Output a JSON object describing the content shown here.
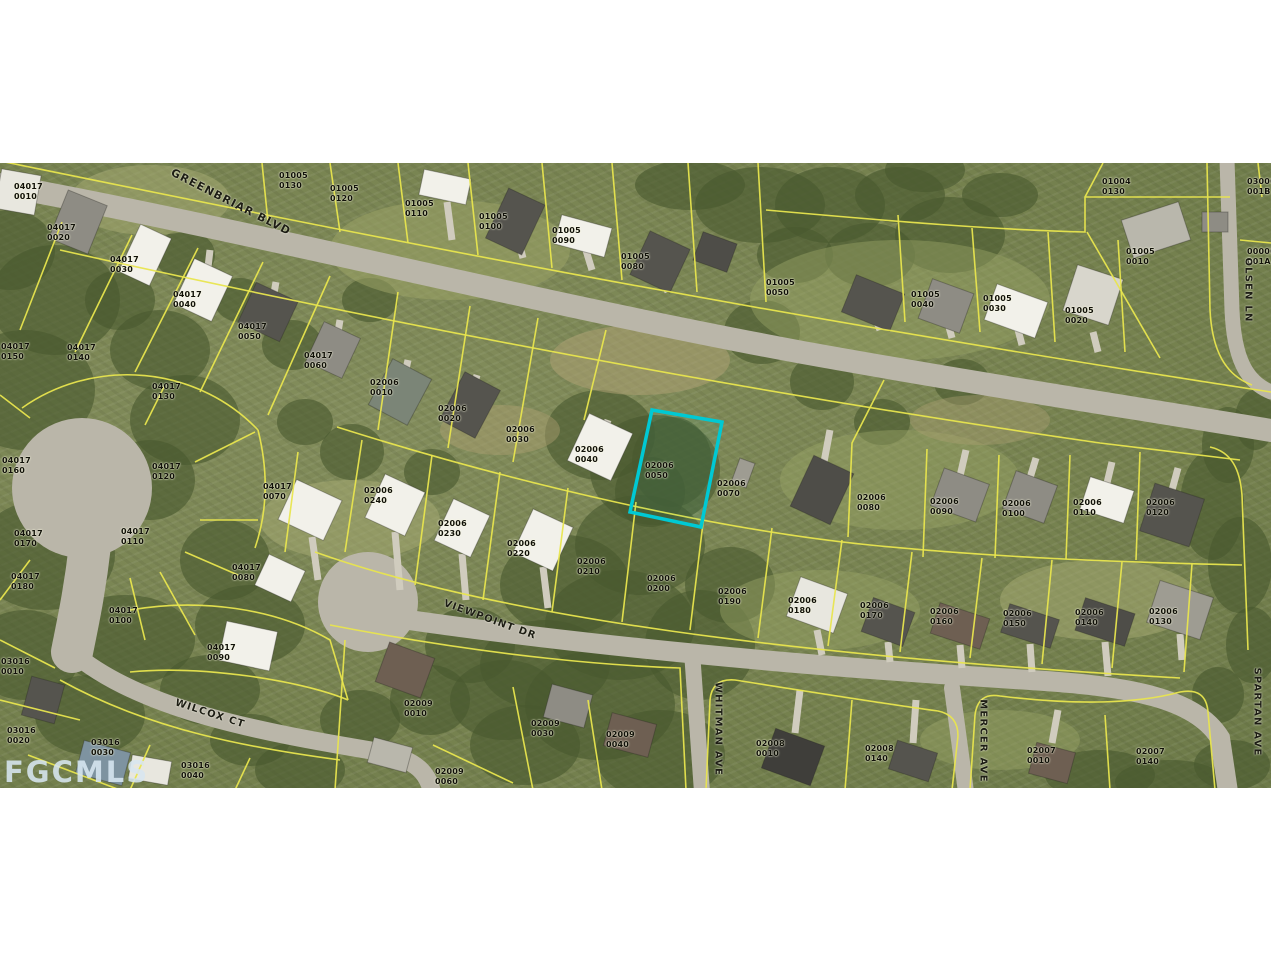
{
  "map": {
    "watermark": "FGCMLS",
    "highlighted_parcel_id": "02006 0050",
    "highlight_color": "#00c9d4",
    "parcel_line_color": "#e8e54e",
    "street_labels": [
      {
        "name": "GREENBRIAR BLVD",
        "x": 231,
        "y": 202,
        "rot": 27,
        "size": 11
      },
      {
        "name": "VIEWPOINT DR",
        "x": 490,
        "y": 620,
        "rot": 20,
        "size": 10
      },
      {
        "name": "WILCOX CT",
        "x": 210,
        "y": 714,
        "rot": 18,
        "size": 10
      },
      {
        "name": "WHITMAN AVE",
        "x": 718,
        "y": 729,
        "rot": 90,
        "size": 10
      },
      {
        "name": "MERCER AVE",
        "x": 983,
        "y": 741,
        "rot": 90,
        "size": 10
      },
      {
        "name": "SPARTAN AVE",
        "x": 1257,
        "y": 712,
        "rot": 90,
        "size": 10
      },
      {
        "name": "OLSEN LN",
        "x": 1248,
        "y": 290,
        "rot": 90,
        "size": 10
      }
    ],
    "parcel_labels": [
      {
        "id": "04017 0010",
        "x": 14,
        "y": 182
      },
      {
        "id": "04017 0020",
        "x": 47,
        "y": 223
      },
      {
        "id": "04017 0030",
        "x": 110,
        "y": 255
      },
      {
        "id": "04017 0040",
        "x": 173,
        "y": 290
      },
      {
        "id": "04017 0050",
        "x": 238,
        "y": 322
      },
      {
        "id": "04017 0060",
        "x": 304,
        "y": 351
      },
      {
        "id": "04017 0070",
        "x": 263,
        "y": 482
      },
      {
        "id": "04017 0080",
        "x": 232,
        "y": 563
      },
      {
        "id": "04017 0090",
        "x": 207,
        "y": 643
      },
      {
        "id": "04017 0100",
        "x": 109,
        "y": 606
      },
      {
        "id": "04017 0110",
        "x": 121,
        "y": 527
      },
      {
        "id": "04017 0120",
        "x": 152,
        "y": 462
      },
      {
        "id": "04017 0130",
        "x": 152,
        "y": 382
      },
      {
        "id": "04017 0140",
        "x": 67,
        "y": 343
      },
      {
        "id": "04017 0150",
        "x": 1,
        "y": 342
      },
      {
        "id": "04017 0160",
        "x": 2,
        "y": 456
      },
      {
        "id": "04017 0170",
        "x": 14,
        "y": 529
      },
      {
        "id": "04017 0180",
        "x": 11,
        "y": 572
      },
      {
        "id": "02006 0010",
        "x": 370,
        "y": 378
      },
      {
        "id": "02006 0020",
        "x": 438,
        "y": 404
      },
      {
        "id": "02006 0030",
        "x": 506,
        "y": 425
      },
      {
        "id": "02006 0040",
        "x": 575,
        "y": 445
      },
      {
        "id": "02006 0050",
        "x": 645,
        "y": 461
      },
      {
        "id": "02006 0070",
        "x": 717,
        "y": 479
      },
      {
        "id": "02006 0080",
        "x": 857,
        "y": 493
      },
      {
        "id": "02006 0090",
        "x": 930,
        "y": 497
      },
      {
        "id": "02006 0100",
        "x": 1002,
        "y": 499
      },
      {
        "id": "02006 0110",
        "x": 1073,
        "y": 498
      },
      {
        "id": "02006 0120",
        "x": 1146,
        "y": 498
      },
      {
        "id": "02006 0130",
        "x": 1149,
        "y": 607
      },
      {
        "id": "02006 0140",
        "x": 1075,
        "y": 608
      },
      {
        "id": "02006 0150",
        "x": 1003,
        "y": 609
      },
      {
        "id": "02006 0160",
        "x": 930,
        "y": 607
      },
      {
        "id": "02006 0170",
        "x": 860,
        "y": 601
      },
      {
        "id": "02006 0180",
        "x": 788,
        "y": 596
      },
      {
        "id": "02006 0190",
        "x": 718,
        "y": 587
      },
      {
        "id": "02006 0200",
        "x": 647,
        "y": 574
      },
      {
        "id": "02006 0210",
        "x": 577,
        "y": 557
      },
      {
        "id": "02006 0220",
        "x": 507,
        "y": 539
      },
      {
        "id": "02006 0230",
        "x": 438,
        "y": 519
      },
      {
        "id": "02006 0240",
        "x": 364,
        "y": 486
      },
      {
        "id": "01005 0130",
        "x": 279,
        "y": 171
      },
      {
        "id": "01005 0120",
        "x": 330,
        "y": 184
      },
      {
        "id": "01005 0110",
        "x": 405,
        "y": 199
      },
      {
        "id": "01005 0100",
        "x": 479,
        "y": 212
      },
      {
        "id": "01005 0090",
        "x": 552,
        "y": 226
      },
      {
        "id": "01005 0080",
        "x": 621,
        "y": 252
      },
      {
        "id": "01005 0050",
        "x": 766,
        "y": 278
      },
      {
        "id": "01005 0040",
        "x": 911,
        "y": 290
      },
      {
        "id": "01005 0030",
        "x": 983,
        "y": 294
      },
      {
        "id": "01005 0020",
        "x": 1065,
        "y": 306
      },
      {
        "id": "01005 0010",
        "x": 1126,
        "y": 247
      },
      {
        "id": "01004 0130",
        "x": 1102,
        "y": 177
      },
      {
        "id": "03000 001B",
        "x": 1247,
        "y": 177
      },
      {
        "id": "00000 001A",
        "x": 1247,
        "y": 247
      },
      {
        "id": "03016 0010",
        "x": 1,
        "y": 657
      },
      {
        "id": "03016 0020",
        "x": 7,
        "y": 726
      },
      {
        "id": "03016 0030",
        "x": 91,
        "y": 738
      },
      {
        "id": "03016 0040",
        "x": 181,
        "y": 761
      },
      {
        "id": "02009 0010",
        "x": 404,
        "y": 699
      },
      {
        "id": "02009 0030",
        "x": 531,
        "y": 719
      },
      {
        "id": "02009 0040",
        "x": 606,
        "y": 730
      },
      {
        "id": "02009 0060",
        "x": 435,
        "y": 767
      },
      {
        "id": "02008 0010",
        "x": 756,
        "y": 739
      },
      {
        "id": "02008 0140",
        "x": 865,
        "y": 744
      },
      {
        "id": "02007 0010",
        "x": 1027,
        "y": 746
      },
      {
        "id": "02007 0140",
        "x": 1136,
        "y": 747
      }
    ]
  }
}
